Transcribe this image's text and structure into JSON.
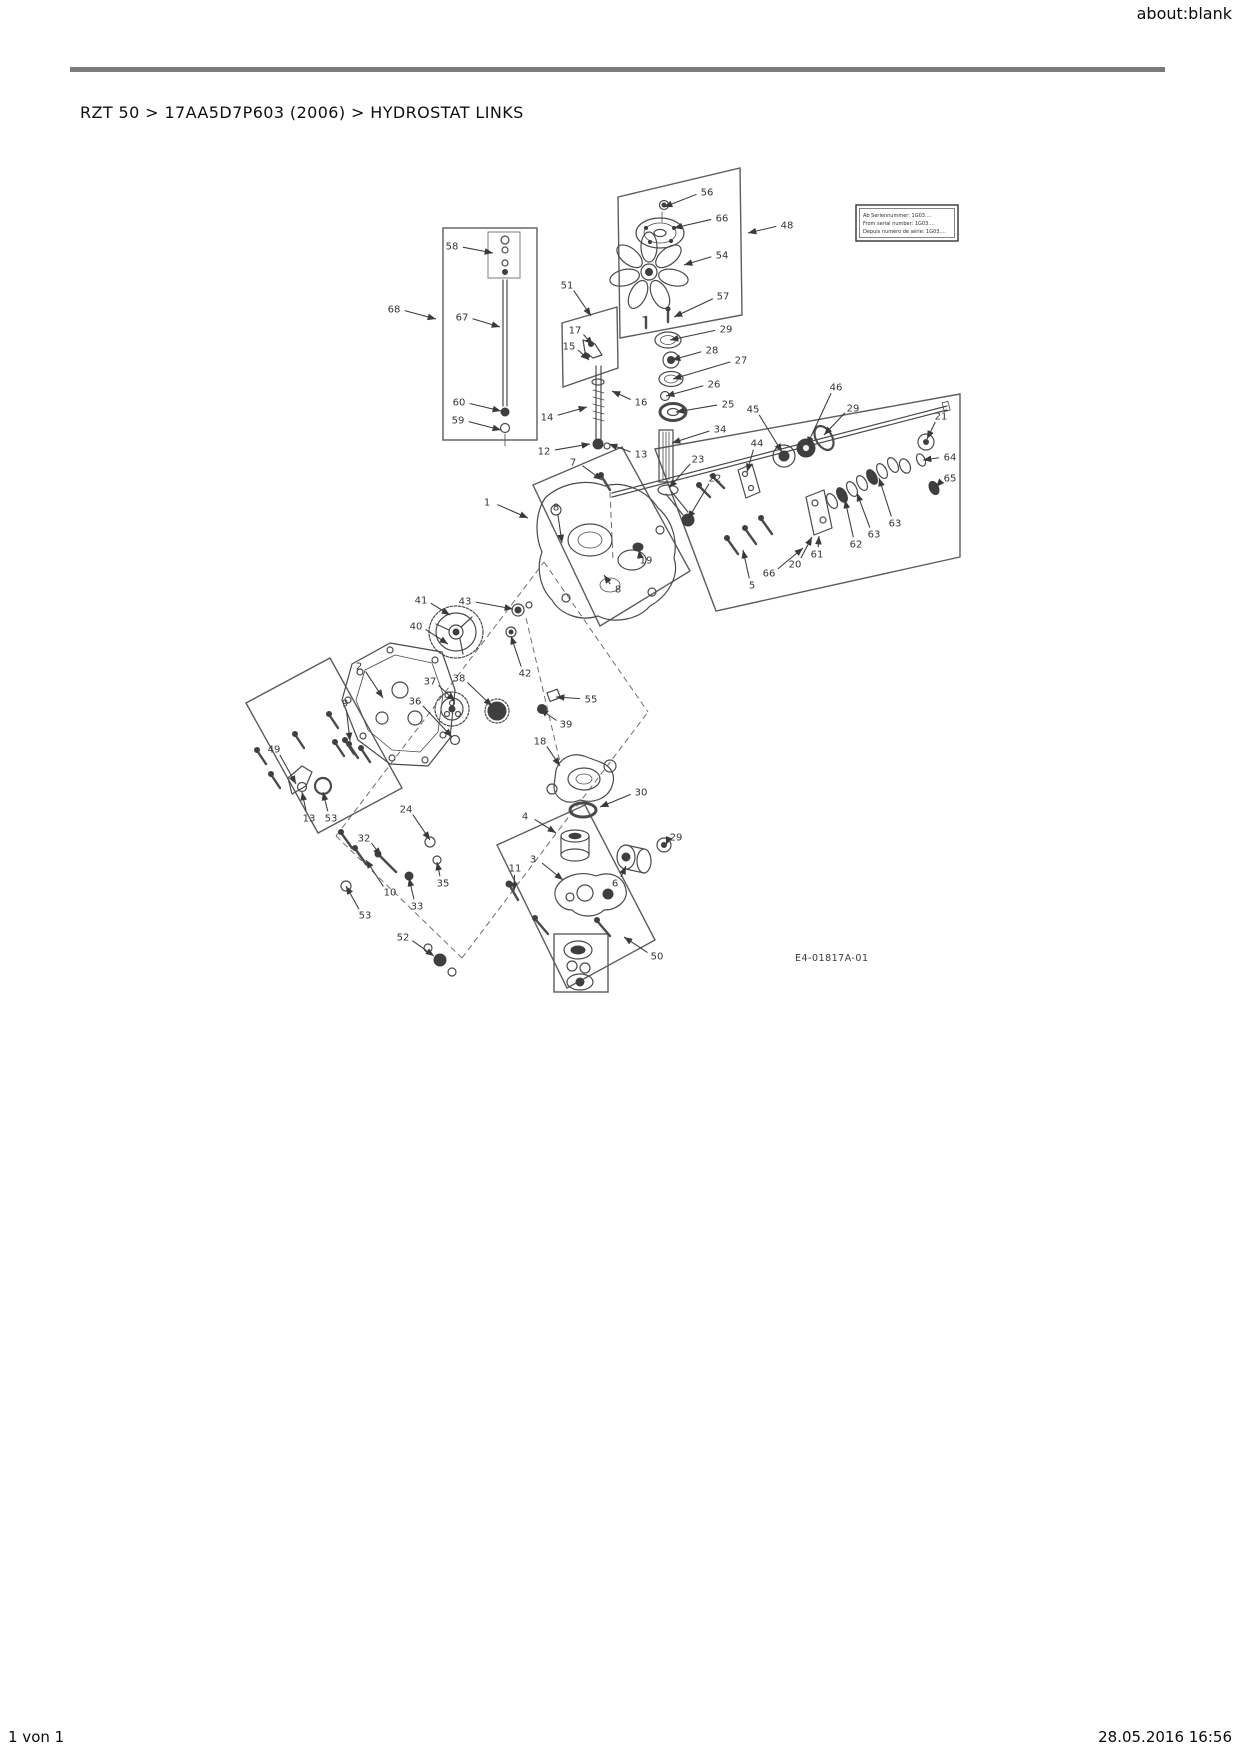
{
  "page": {
    "header_right": "about:blank",
    "breadcrumb": "RZT 50  >  17AA5D7P603 (2006)  >  HYDROSTAT LINKS",
    "footer_left": "1 von 1",
    "footer_right": "28.05.2016 16:56"
  },
  "diagram": {
    "drawing_number": "E4-01817A-01",
    "note_box": {
      "line1": "Ab Seriennummer: 1G03....",
      "line2": "From serial number: 1G03....",
      "line3": "Depuis numéro de série: 1G03...."
    },
    "callouts": [
      {
        "label": "56",
        "x": 707,
        "y": 192,
        "tx": 664,
        "ty": 207
      },
      {
        "label": "66",
        "x": 722,
        "y": 218,
        "tx": 674,
        "ty": 228
      },
      {
        "label": "48",
        "x": 787,
        "y": 225,
        "tx": 748,
        "ty": 233
      },
      {
        "label": "54",
        "x": 722,
        "y": 255,
        "tx": 684,
        "ty": 265
      },
      {
        "label": "57",
        "x": 723,
        "y": 296,
        "tx": 674,
        "ty": 317
      },
      {
        "label": "51",
        "x": 567,
        "y": 285,
        "tx": 591,
        "ty": 316
      },
      {
        "label": "17",
        "x": 575,
        "y": 330,
        "tx": 593,
        "ty": 345
      },
      {
        "label": "15",
        "x": 569,
        "y": 346,
        "tx": 589,
        "ty": 360
      },
      {
        "label": "29",
        "x": 726,
        "y": 329,
        "tx": 670,
        "ty": 340
      },
      {
        "label": "28",
        "x": 712,
        "y": 350,
        "tx": 672,
        "ty": 360
      },
      {
        "label": "27",
        "x": 741,
        "y": 360,
        "tx": 673,
        "ty": 379
      },
      {
        "label": "26",
        "x": 714,
        "y": 384,
        "tx": 666,
        "ty": 396
      },
      {
        "label": "25",
        "x": 728,
        "y": 404,
        "tx": 676,
        "ty": 412
      },
      {
        "label": "34",
        "x": 720,
        "y": 429,
        "tx": 672,
        "ty": 443
      },
      {
        "label": "23",
        "x": 698,
        "y": 459,
        "tx": 669,
        "ty": 488
      },
      {
        "label": "22",
        "x": 715,
        "y": 478,
        "tx": 688,
        "ty": 519
      },
      {
        "label": "16",
        "x": 641,
        "y": 402,
        "tx": 612,
        "ty": 391
      },
      {
        "label": "14",
        "x": 547,
        "y": 417,
        "tx": 587,
        "ty": 407
      },
      {
        "label": "12",
        "x": 544,
        "y": 451,
        "tx": 590,
        "ty": 444
      },
      {
        "label": "13",
        "x": 641,
        "y": 454,
        "tx": 609,
        "ty": 444
      },
      {
        "label": "7",
        "x": 573,
        "y": 462,
        "tx": 602,
        "ty": 480
      },
      {
        "label": "58",
        "x": 452,
        "y": 246,
        "tx": 493,
        "ty": 253
      },
      {
        "label": "68",
        "x": 394,
        "y": 309,
        "tx": 436,
        "ty": 319
      },
      {
        "label": "67",
        "x": 462,
        "y": 317,
        "tx": 500,
        "ty": 327
      },
      {
        "label": "60",
        "x": 459,
        "y": 402,
        "tx": 501,
        "ty": 411
      },
      {
        "label": "59",
        "x": 458,
        "y": 420,
        "tx": 501,
        "ty": 430
      },
      {
        "label": "44",
        "x": 757,
        "y": 443,
        "tx": 747,
        "ty": 472
      },
      {
        "label": "45",
        "x": 753,
        "y": 409,
        "tx": 782,
        "ty": 452
      },
      {
        "label": "46",
        "x": 836,
        "y": 387,
        "tx": 807,
        "ty": 445
      },
      {
        "label": "29",
        "x": 853,
        "y": 408,
        "tx": 824,
        "ty": 435
      },
      {
        "label": "21",
        "x": 941,
        "y": 416,
        "tx": 927,
        "ty": 439
      },
      {
        "label": "64",
        "x": 950,
        "y": 457,
        "tx": 923,
        "ty": 460
      },
      {
        "label": "65",
        "x": 950,
        "y": 478,
        "tx": 936,
        "ty": 487
      },
      {
        "label": "61",
        "x": 817,
        "y": 554,
        "tx": 819,
        "ty": 536
      },
      {
        "label": "62",
        "x": 856,
        "y": 544,
        "tx": 845,
        "ty": 500
      },
      {
        "label": "63",
        "x": 874,
        "y": 534,
        "tx": 857,
        "ty": 493
      },
      {
        "label": "63",
        "x": 895,
        "y": 523,
        "tx": 879,
        "ty": 478
      },
      {
        "label": "20",
        "x": 795,
        "y": 564,
        "tx": 812,
        "ty": 537
      },
      {
        "label": "5",
        "x": 752,
        "y": 585,
        "tx": 743,
        "ty": 550
      },
      {
        "label": "66",
        "x": 769,
        "y": 573,
        "tx": 803,
        "ty": 548
      },
      {
        "label": "19",
        "x": 646,
        "y": 560,
        "tx": 639,
        "ty": 550
      },
      {
        "label": "1",
        "x": 487,
        "y": 502,
        "tx": 528,
        "ty": 518
      },
      {
        "label": "8",
        "x": 556,
        "y": 507,
        "tx": 562,
        "ty": 543
      },
      {
        "label": "8",
        "x": 618,
        "y": 589,
        "tx": 604,
        "ty": 575
      },
      {
        "label": "41",
        "x": 421,
        "y": 600,
        "tx": 450,
        "ty": 615
      },
      {
        "label": "43",
        "x": 465,
        "y": 601,
        "tx": 513,
        "ty": 609
      },
      {
        "label": "40",
        "x": 416,
        "y": 626,
        "tx": 448,
        "ty": 644
      },
      {
        "label": "42",
        "x": 525,
        "y": 673,
        "tx": 511,
        "ty": 636
      },
      {
        "label": "2",
        "x": 359,
        "y": 666,
        "tx": 383,
        "ty": 698
      },
      {
        "label": "37",
        "x": 430,
        "y": 681,
        "tx": 455,
        "ty": 701
      },
      {
        "label": "38",
        "x": 459,
        "y": 678,
        "tx": 492,
        "ty": 706
      },
      {
        "label": "36",
        "x": 415,
        "y": 701,
        "tx": 452,
        "ty": 737
      },
      {
        "label": "9",
        "x": 345,
        "y": 703,
        "tx": 350,
        "ty": 741
      },
      {
        "label": "49",
        "x": 274,
        "y": 749,
        "tx": 296,
        "ty": 784
      },
      {
        "label": "55",
        "x": 591,
        "y": 699,
        "tx": 556,
        "ty": 697
      },
      {
        "label": "39",
        "x": 566,
        "y": 724,
        "tx": 540,
        "ty": 709
      },
      {
        "label": "18",
        "x": 540,
        "y": 741,
        "tx": 560,
        "ty": 766
      },
      {
        "label": "30",
        "x": 641,
        "y": 792,
        "tx": 600,
        "ty": 807
      },
      {
        "label": "4",
        "x": 525,
        "y": 816,
        "tx": 556,
        "ty": 833
      },
      {
        "label": "3",
        "x": 533,
        "y": 859,
        "tx": 563,
        "ty": 880
      },
      {
        "label": "11",
        "x": 515,
        "y": 868,
        "tx": 514,
        "ty": 891
      },
      {
        "label": "10",
        "x": 390,
        "y": 892,
        "tx": 366,
        "ty": 860
      },
      {
        "label": "13",
        "x": 309,
        "y": 818,
        "tx": 302,
        "ty": 792
      },
      {
        "label": "53",
        "x": 331,
        "y": 818,
        "tx": 323,
        "ty": 792
      },
      {
        "label": "24",
        "x": 406,
        "y": 809,
        "tx": 430,
        "ty": 840
      },
      {
        "label": "32",
        "x": 364,
        "y": 838,
        "tx": 381,
        "ty": 856
      },
      {
        "label": "35",
        "x": 443,
        "y": 883,
        "tx": 437,
        "ty": 862
      },
      {
        "label": "33",
        "x": 417,
        "y": 906,
        "tx": 409,
        "ty": 878
      },
      {
        "label": "53",
        "x": 365,
        "y": 915,
        "tx": 346,
        "ty": 886
      },
      {
        "label": "52",
        "x": 403,
        "y": 937,
        "tx": 434,
        "ty": 956
      },
      {
        "label": "50",
        "x": 657,
        "y": 956,
        "tx": 624,
        "ty": 937
      },
      {
        "label": "6",
        "x": 615,
        "y": 883,
        "tx": 626,
        "ty": 866
      },
      {
        "label": "29",
        "x": 676,
        "y": 837,
        "tx": 666,
        "ty": 845
      }
    ]
  }
}
